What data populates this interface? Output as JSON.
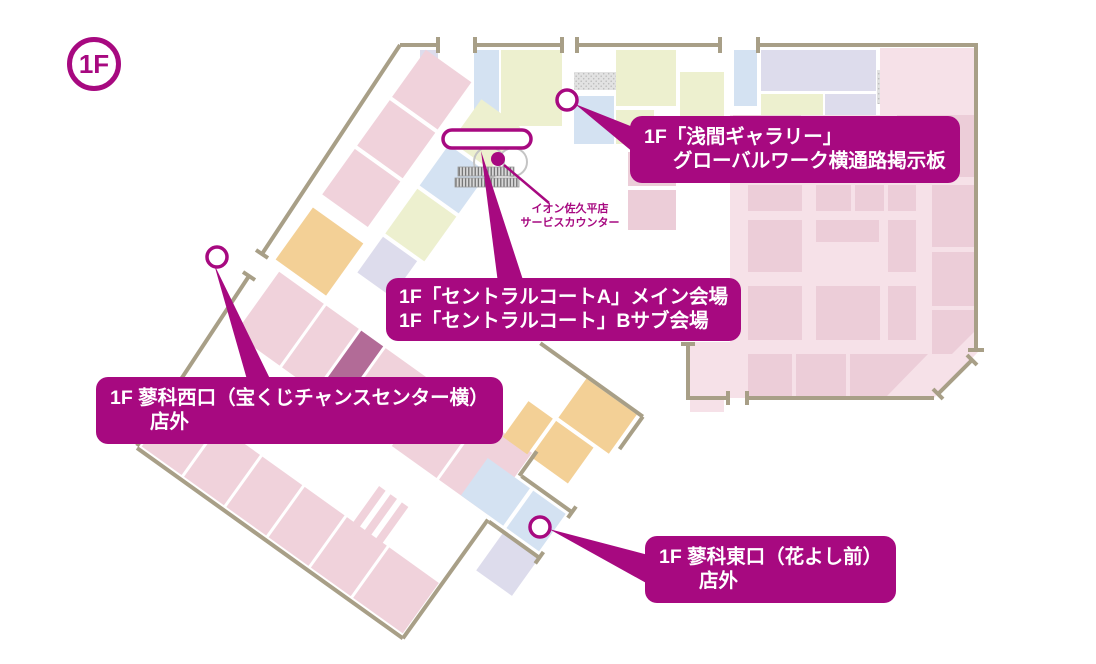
{
  "floor_badge": "1F",
  "colors": {
    "magenta": "#a70980",
    "wall": "#a89f87",
    "room_pink": "#f0d2db",
    "room_pink_light": "#f6e1e8",
    "room_pink_deep": "#eccdd8",
    "room_green": "#edf0cf",
    "room_lavender": "#dddcec",
    "room_blue": "#d4e2f2",
    "room_orange": "#f3d096",
    "room_plum": "#b26b97",
    "bg": "#ffffff"
  },
  "labels": {
    "gallery": {
      "line1": "1F「浅間ギャラリー」",
      "line2": "グローバルワーク横通路掲示板"
    },
    "central": {
      "line1": "1F「セントラルコートA」メイン会場",
      "line2": "1F「セントラルコート」Bサブ会場"
    },
    "west": {
      "line1": "1F 蓼科西口（宝くじチャンスセンター横）",
      "line2": "店外"
    },
    "east": {
      "line1": "1F 蓼科東口（花よし前）",
      "line2": "店外"
    }
  },
  "annotations": {
    "service_counter": {
      "line1": "イオン佐久平店",
      "line2": "サービスカウンター"
    }
  }
}
